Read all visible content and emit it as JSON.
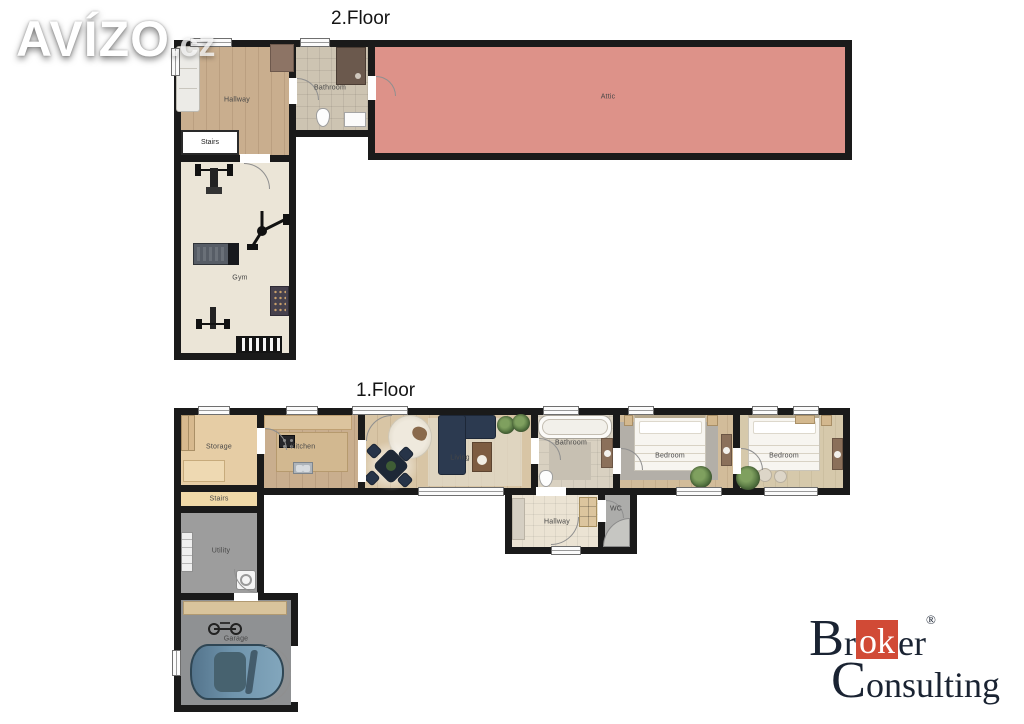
{
  "watermark": {
    "brand": "AVÍZO",
    "suffix": ".cz"
  },
  "floor2": {
    "title": "2.Floor",
    "rooms": {
      "hallway": "Hallway",
      "bathroom": "Bathroom",
      "attic": "Attic",
      "stairs": "Stairs",
      "gym": "Gym"
    }
  },
  "floor1": {
    "title": "1.Floor",
    "rooms": {
      "storage": "Storage",
      "kitchen": "Kitchen",
      "living": "Living",
      "bathroom": "Bathroom",
      "bedroom_left": "Bedroom",
      "bedroom_right": "Bedroom",
      "stairs": "Stairs",
      "utility": "Utility",
      "garage": "Garage",
      "hallway": "Hallway",
      "wc": "WC"
    }
  },
  "branding": {
    "line1_pre": "Br",
    "line1_highlight": "ok",
    "line1_post": "er",
    "registered": "®",
    "line2": "Consulting"
  },
  "colors": {
    "wall": "#1a1a1a",
    "attic": "#dd9289",
    "brand_red": "#d14a36",
    "logo_text": "#1a2332"
  }
}
